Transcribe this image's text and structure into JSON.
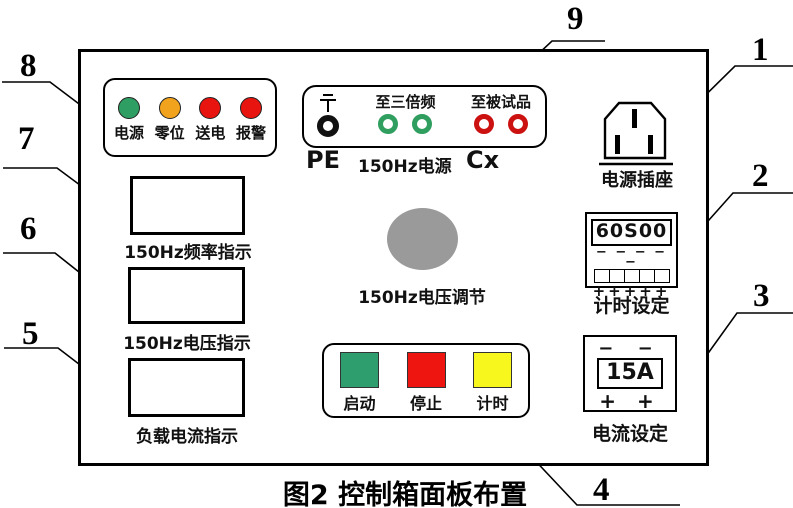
{
  "caption": "图2  控制箱面板布置",
  "callouts": [
    {
      "n": "1"
    },
    {
      "n": "2"
    },
    {
      "n": "3"
    },
    {
      "n": "4"
    },
    {
      "n": "5"
    },
    {
      "n": "6"
    },
    {
      "n": "7"
    },
    {
      "n": "8"
    },
    {
      "n": "9"
    }
  ],
  "indicator_panel": {
    "lights": [
      {
        "label": "电源",
        "color": "#2f9e62"
      },
      {
        "label": "零位",
        "color": "#f2a31d"
      },
      {
        "label": "送电",
        "color": "#e81410"
      },
      {
        "label": "报警",
        "color": "#e81410"
      }
    ]
  },
  "terminal_panel": {
    "group1_label": "至三倍频",
    "group2_label": "至被试品",
    "pe_label": "PE",
    "source_label": "150Hz电源",
    "cx_label": "Cx",
    "pe_color": "#111111",
    "source_color": "#2f9e5f",
    "cx_color": "#cc1111"
  },
  "socket": {
    "label": "电源插座"
  },
  "timer": {
    "display": "60S00",
    "dashes": "− − − − −",
    "pluses": "+++++",
    "label": "计时设定"
  },
  "current": {
    "minuses": "− −",
    "display": "15A",
    "pluses": "+ +",
    "label": "电流设定"
  },
  "meters": [
    {
      "label": "150Hz频率指示"
    },
    {
      "label": "150Hz电压指示"
    },
    {
      "label": "负载电流指示"
    }
  ],
  "knob": {
    "label": "150Hz电压调节",
    "color": "#9a9a9a"
  },
  "buttons": [
    {
      "label": "启动",
      "color": "#2f9e6e"
    },
    {
      "label": "停止",
      "color": "#ee1511"
    },
    {
      "label": "计时",
      "color": "#f7f71e"
    }
  ]
}
